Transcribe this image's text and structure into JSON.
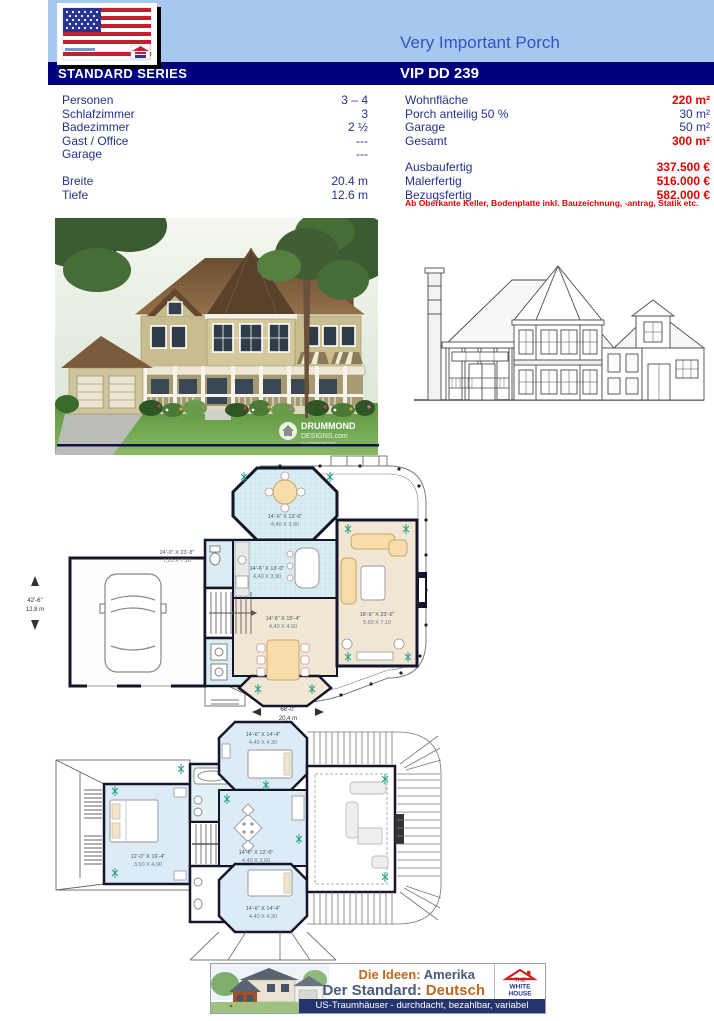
{
  "header": {
    "title": "Very Important Porch",
    "series": "STANDARD SERIES",
    "model": "VIP DD 239"
  },
  "specs": {
    "left": [
      {
        "label": "Personen",
        "value": "3 – 4"
      },
      {
        "label": "Schlafzimmer",
        "value": "3"
      },
      {
        "label": "Badezimmer",
        "value": "2 ½"
      },
      {
        "label": "Gast / Office",
        "value": "---"
      },
      {
        "label": "Garage",
        "value": "---"
      },
      {
        "label": "Breite",
        "value": "20.4 m"
      },
      {
        "label": "Tiefe",
        "value": "12.6 m"
      }
    ],
    "right": [
      {
        "label": "Wohnfläche",
        "value": "220 m²"
      },
      {
        "label": "Porch anteilig 50 %",
        "value": "30 m²"
      },
      {
        "label": "Garage",
        "value": "50 m²"
      },
      {
        "label": "Gesamt",
        "value": "300 m²"
      },
      {
        "label": "Ausbaufertig",
        "value": "337.500 €"
      },
      {
        "label": "Malerfertig",
        "value": "516.000 €"
      },
      {
        "label": "Bezugsfertig",
        "value": "582.000 €"
      }
    ],
    "note": "Ab Oberkante Keller, Bodenplatte inkl. Bauzeichnung, -antrag, Statik etc."
  },
  "rendering": {
    "brand_line1": "DRUMMOND",
    "brand_line2": "DESIGNS.com",
    "brand_line3": "© COPYRIGHT"
  },
  "plans": {
    "floor1": {
      "garage_imperial": "24'-0\" X 23'-8\"",
      "garage_metric": "7,20 X 7,10",
      "nook_imperial": "14'-6\" X 13'-0\"",
      "nook_metric": "4,40 X 3,90",
      "kitchen_imperial": "14'-6\" X 13'-0\"",
      "kitchen_metric": "4,40 X 3,90",
      "dining_imperial": "14'-6\" X 15'-4\"",
      "dining_metric": "4,40 X 4,60",
      "living_imperial": "18'-6\" X 23'-6\"",
      "living_metric": "5,60 X 7,10",
      "width_imperial": "42'-6\"",
      "width_metric": "12,8 m",
      "length_imperial": "68'-0\"",
      "length_metric": "20,4 m"
    },
    "floor2": {
      "bedroom_top_imperial": "14'-6\" X 14'-4\"",
      "bedroom_top_metric": "4,40 X 4,30",
      "master_imperial": "12'-0\" X 16'-4\"",
      "master_metric": "3,60 X 4,90",
      "hall_imperial": "14'-6\" X 12'-0\"",
      "hall_metric": "4,40 X 3,60",
      "bedroom_bottom_imperial": "14'-6\" X 14'-4\"",
      "bedroom_bottom_metric": "4,40 X 4,30"
    }
  },
  "footer": {
    "idea_label": "Die Ideen:",
    "idea_value": " Amerika",
    "standard_label": "Der Standard:",
    "standard_value": " Deutsch",
    "tagline": "US-Traumhäuser - durchdacht, bezahlbar, variabel",
    "logo_the": "THE",
    "logo_white": "WHITE",
    "logo_house": "HOUSE"
  },
  "colors": {
    "header_blue": "#a5c9ee",
    "bar_navy": "#00007e",
    "title_blue": "#3152c8",
    "text_navy": "#24328f",
    "value_red": "#e80000",
    "footer_orange": "#c2661f",
    "footer_slate": "#4a5a78"
  }
}
